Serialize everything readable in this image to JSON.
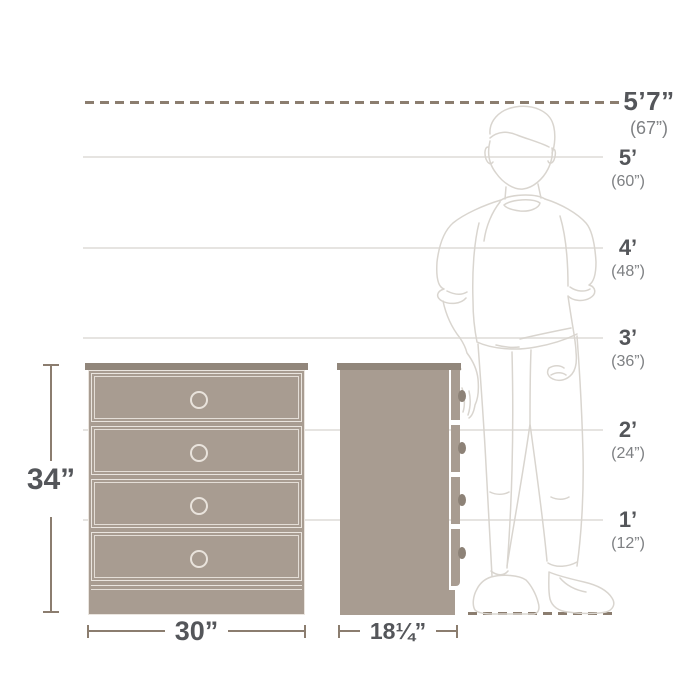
{
  "diagram_type": "furniture-size-comparison",
  "scale": {
    "marks": [
      {
        "feet": "5’7”",
        "inches": "(67”)"
      },
      {
        "feet": "5’",
        "inches": "(60”)"
      },
      {
        "feet": "4’",
        "inches": "(48”)"
      },
      {
        "feet": "3’",
        "inches": "(36”)"
      },
      {
        "feet": "2’",
        "inches": "(24”)"
      },
      {
        "feet": "1’",
        "inches": "(12”)"
      }
    ]
  },
  "product": {
    "height_label": "34”",
    "width_label": "30”",
    "depth_label": "18¼”",
    "drawer_count": 4
  },
  "figure": {
    "name": "standing-person-outline",
    "reference_height": "5’7” (67”)"
  },
  "colors": {
    "text_dark": "#54565a",
    "text_secondary": "#7e8083",
    "dimension_line": "#8b7d6f",
    "gridline": "#e6e4e1",
    "furniture_fill": "#a89c91",
    "furniture_top": "#91867b",
    "furniture_detail_line": "#eae5df",
    "figure_outline": "#d9d5cf",
    "background": "#ffffff"
  }
}
